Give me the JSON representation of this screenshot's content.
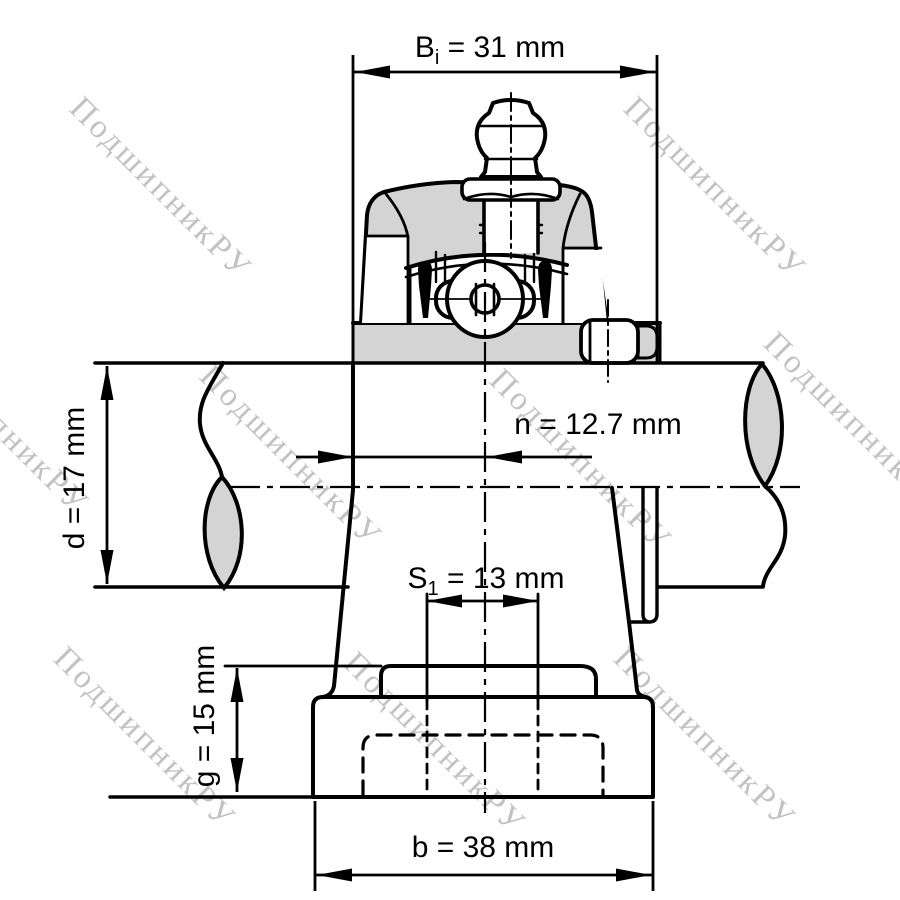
{
  "diagram": {
    "title": "pillow-block-bearing-unit-drawing",
    "watermark_text": "ПодшипникРУ",
    "dimensions": {
      "bi": {
        "base": "B",
        "sub": "i",
        "rest": " = 31 mm"
      },
      "n": {
        "label": "n = 12.7 mm"
      },
      "d": {
        "label": "d = 17 mm"
      },
      "s1": {
        "base": "S",
        "sub": "1",
        "rest": " = 13 mm"
      },
      "g": {
        "label": "g = 15 mm"
      },
      "b": {
        "label": "b = 38 mm"
      }
    },
    "colors": {
      "line": "#000000",
      "metal_fill": "#d4d4d4",
      "watermark": "#c2c2c2",
      "background": "#ffffff"
    }
  }
}
